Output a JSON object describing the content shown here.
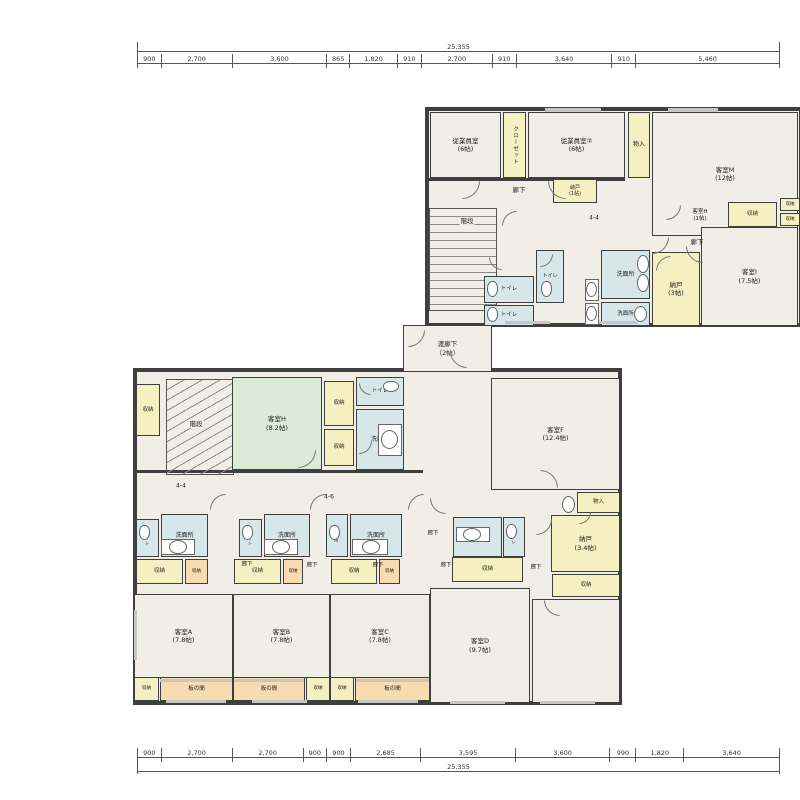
{
  "colors": {
    "cream": "#f0eee7",
    "yellow": "#f5f0c1",
    "blue": "#d7e6e9",
    "green": "#dcead7",
    "peach": "#f7dcb2",
    "wall": "#3f3f3f",
    "line": "#666666"
  },
  "dimensions": {
    "top": {
      "total": "25,355",
      "segments": [
        {
          "label": "900",
          "mm": 900
        },
        {
          "label": "2,700",
          "mm": 2700
        },
        {
          "label": "3,600",
          "mm": 3600
        },
        {
          "label": "865",
          "mm": 865
        },
        {
          "label": "1,820",
          "mm": 1820
        },
        {
          "label": "910",
          "mm": 910
        },
        {
          "label": "2,700",
          "mm": 2700
        },
        {
          "label": "910",
          "mm": 910
        },
        {
          "label": "3,640",
          "mm": 3640
        },
        {
          "label": "910",
          "mm": 910
        },
        {
          "label": "5,460",
          "mm": 5460
        }
      ]
    },
    "bottom": {
      "total": "25,355",
      "segments": [
        {
          "label": "900",
          "mm": 900
        },
        {
          "label": "2,700",
          "mm": 2700
        },
        {
          "label": "2,700",
          "mm": 2700
        },
        {
          "label": "900",
          "mm": 900
        },
        {
          "label": "900",
          "mm": 900
        },
        {
          "label": "2,685",
          "mm": 2685
        },
        {
          "label": "3,595",
          "mm": 3595
        },
        {
          "label": "3,600",
          "mm": 3600
        },
        {
          "label": "990",
          "mm": 990
        },
        {
          "label": "1,820",
          "mm": 1820
        },
        {
          "label": "3,640",
          "mm": 3640
        }
      ]
    }
  },
  "sections": [
    {
      "id": "upper-wing",
      "x": 425,
      "y": 107,
      "w": 378,
      "h": 220
    },
    {
      "id": "lower-wing",
      "x": 133,
      "y": 368,
      "w": 489,
      "h": 337
    }
  ],
  "rooms": [
    {
      "id": "staff-room-1",
      "label": "従業員室\n(6帖)",
      "x": 430,
      "y": 112,
      "w": 71,
      "h": 66,
      "fill": "cream"
    },
    {
      "id": "closet-strip",
      "label": "クローゼット",
      "x": 503,
      "y": 112,
      "w": 23,
      "h": 66,
      "fill": "yellow",
      "vert": true,
      "fs": 5.5
    },
    {
      "id": "staff-room-2",
      "label": "従業員室②\n(6帖)",
      "x": 528,
      "y": 112,
      "w": 97,
      "h": 66,
      "fill": "cream"
    },
    {
      "id": "monoire-upper",
      "label": "物入",
      "x": 628,
      "y": 112,
      "w": 22,
      "h": 66,
      "fill": "yellow",
      "fs": 6
    },
    {
      "id": "guest-room-M",
      "label": "客室M\n(12帖)",
      "x": 652,
      "y": 112,
      "w": 146,
      "h": 124,
      "fill": "cream"
    },
    {
      "id": "nando-1",
      "label": "納戸\n(1帖)",
      "x": 553,
      "y": 179,
      "w": 44,
      "h": 24,
      "fill": "yellow",
      "fs": 5
    },
    {
      "id": "shuno-upper",
      "label": "収納",
      "x": 728,
      "y": 202,
      "w": 49,
      "h": 25,
      "fill": "yellow",
      "fs": 5.5
    },
    {
      "id": "shuno-edge-1",
      "label": "収納",
      "x": 780,
      "y": 198,
      "w": 20,
      "h": 13,
      "fill": "yellow",
      "fs": 4.5,
      "clip": true
    },
    {
      "id": "shuno-edge-2",
      "label": "収納",
      "x": 780,
      "y": 213,
      "w": 20,
      "h": 13,
      "fill": "yellow",
      "fs": 4.5,
      "clip": true
    },
    {
      "id": "toilet-up-1",
      "label": "トイレ",
      "x": 484,
      "y": 276,
      "w": 50,
      "h": 27,
      "fill": "blue",
      "fs": 5.5
    },
    {
      "id": "toilet-up-2",
      "label": "トイレ",
      "x": 536,
      "y": 250,
      "w": 28,
      "h": 53,
      "fill": "blue",
      "fs": 5
    },
    {
      "id": "toilet-up-3",
      "label": "トイレ",
      "x": 484,
      "y": 305,
      "w": 50,
      "h": 21,
      "fill": "blue",
      "fs": 5.5
    },
    {
      "id": "washroom-up-1",
      "label": "洗面所",
      "x": 601,
      "y": 250,
      "w": 49,
      "h": 49,
      "fill": "blue",
      "fs": 6
    },
    {
      "id": "washroom-up-2",
      "label": "洗面所",
      "x": 601,
      "y": 302,
      "w": 49,
      "h": 24,
      "fill": "blue",
      "fs": 5.5
    },
    {
      "id": "nando-3",
      "label": "納戸\n(3帖)",
      "x": 652,
      "y": 252,
      "w": 48,
      "h": 74,
      "fill": "yellow"
    },
    {
      "id": "guest-room-I",
      "label": "客室I\n(7.5帖)",
      "x": 701,
      "y": 227,
      "w": 97,
      "h": 99,
      "fill": "cream"
    },
    {
      "id": "watari-rouka",
      "label": "渡廊下\n（2帖）",
      "x": 403,
      "y": 325,
      "w": 89,
      "h": 47,
      "fill": "cream"
    },
    {
      "id": "shuno-left",
      "label": "収納",
      "x": 136,
      "y": 384,
      "w": 24,
      "h": 52,
      "fill": "yellow",
      "fs": 5.5
    },
    {
      "id": "guest-room-H",
      "label": "客室H\n(8.2帖)",
      "x": 232,
      "y": 377,
      "w": 90,
      "h": 93,
      "fill": "green"
    },
    {
      "id": "shuno-h-1",
      "label": "収納",
      "x": 324,
      "y": 381,
      "w": 30,
      "h": 45,
      "fill": "yellow",
      "fs": 5.5
    },
    {
      "id": "shuno-h-2",
      "label": "収納",
      "x": 324,
      "y": 429,
      "w": 30,
      "h": 37,
      "fill": "yellow",
      "fs": 5.5
    },
    {
      "id": "toilet-h",
      "label": "トイレ",
      "x": 356,
      "y": 377,
      "w": 48,
      "h": 29,
      "fill": "blue",
      "fs": 5.5
    },
    {
      "id": "washroom-h",
      "label": "洗面所",
      "x": 356,
      "y": 409,
      "w": 48,
      "h": 61,
      "fill": "blue",
      "fs": 6
    },
    {
      "id": "guest-room-F",
      "label": "客室F\n(12.4帖)",
      "x": 491,
      "y": 378,
      "w": 129,
      "h": 112,
      "fill": "cream"
    },
    {
      "id": "monoire-lower",
      "label": "物入",
      "x": 577,
      "y": 492,
      "w": 43,
      "h": 21,
      "fill": "yellow",
      "fs": 5.5
    },
    {
      "id": "nando-34",
      "label": "納戸\n(3.4帖)",
      "x": 551,
      "y": 515,
      "w": 69,
      "h": 57,
      "fill": "yellow"
    },
    {
      "id": "shuno-nando",
      "label": "収納",
      "x": 552,
      "y": 574,
      "w": 68,
      "h": 23,
      "fill": "yellow",
      "fs": 5.5
    },
    {
      "id": "toilet-a",
      "label": "トイレ",
      "x": 136,
      "y": 519,
      "w": 23,
      "h": 38,
      "fill": "blue",
      "fs": 4,
      "vert": true
    },
    {
      "id": "washroom-a",
      "label": "洗面所",
      "x": 161,
      "y": 514,
      "w": 47,
      "h": 43,
      "fill": "blue",
      "fs": 6
    },
    {
      "id": "shuno-a1",
      "label": "収納",
      "x": 136,
      "y": 559,
      "w": 47,
      "h": 25,
      "fill": "yellow",
      "fs": 5.5
    },
    {
      "id": "shuno-a2",
      "label": "収納",
      "x": 185,
      "y": 559,
      "w": 23,
      "h": 25,
      "fill": "peach",
      "fs": 4.5
    },
    {
      "id": "guest-room-A",
      "label": "客室A\n(7.8帖)",
      "x": 134,
      "y": 594,
      "w": 99,
      "h": 84,
      "fill": "cream"
    },
    {
      "id": "shuno-a3",
      "label": "収納",
      "x": 134,
      "y": 677,
      "w": 25,
      "h": 24,
      "fill": "yellow",
      "fs": 4.5
    },
    {
      "id": "itanoma-a",
      "label": "板の間",
      "x": 160,
      "y": 677,
      "w": 73,
      "h": 24,
      "fill": "peach",
      "fs": 5.5
    },
    {
      "id": "toilet-b",
      "label": "トイレ",
      "x": 239,
      "y": 519,
      "w": 23,
      "h": 38,
      "fill": "blue",
      "fs": 4,
      "vert": true
    },
    {
      "id": "washroom-b",
      "label": "洗面所",
      "x": 264,
      "y": 514,
      "w": 46,
      "h": 43,
      "fill": "blue",
      "fs": 6
    },
    {
      "id": "shuno-b1",
      "label": "収納",
      "x": 234,
      "y": 559,
      "w": 47,
      "h": 25,
      "fill": "yellow",
      "fs": 5.5
    },
    {
      "id": "shuno-b2",
      "label": "収納",
      "x": 283,
      "y": 559,
      "w": 20,
      "h": 25,
      "fill": "peach",
      "fs": 4.5
    },
    {
      "id": "guest-room-B",
      "label": "客室B\n(7.8帖)",
      "x": 233,
      "y": 594,
      "w": 97,
      "h": 84,
      "fill": "cream"
    },
    {
      "id": "itanoma-b",
      "label": "板の間",
      "x": 233,
      "y": 677,
      "w": 72,
      "h": 24,
      "fill": "peach",
      "fs": 5.5
    },
    {
      "id": "shuno-b3",
      "label": "収納",
      "x": 306,
      "y": 677,
      "w": 24,
      "h": 24,
      "fill": "yellow",
      "fs": 4.5
    },
    {
      "id": "washroom-c-small",
      "label": "洗面所",
      "x": 326,
      "y": 514,
      "w": 22,
      "h": 43,
      "fill": "blue",
      "fs": 4,
      "vert": true
    },
    {
      "id": "washroom-c",
      "label": "洗面所",
      "x": 350,
      "y": 514,
      "w": 52,
      "h": 43,
      "fill": "blue",
      "fs": 6
    },
    {
      "id": "shuno-c1",
      "label": "収納",
      "x": 331,
      "y": 559,
      "w": 46,
      "h": 25,
      "fill": "yellow",
      "fs": 5.5
    },
    {
      "id": "shuno-c2",
      "label": "収納",
      "x": 379,
      "y": 559,
      "w": 21,
      "h": 25,
      "fill": "peach",
      "fs": 4.5
    },
    {
      "id": "guest-room-C",
      "label": "客室C\n(7.8帖)",
      "x": 330,
      "y": 594,
      "w": 100,
      "h": 84,
      "fill": "cream"
    },
    {
      "id": "shuno-c3",
      "label": "収納",
      "x": 330,
      "y": 677,
      "w": 24,
      "h": 24,
      "fill": "yellow",
      "fs": 4.5
    },
    {
      "id": "itanoma-c",
      "label": "板の間",
      "x": 355,
      "y": 677,
      "w": 75,
      "h": 24,
      "fill": "peach",
      "fs": 5.5
    },
    {
      "id": "washroom-d",
      "label": "洗面所",
      "x": 453,
      "y": 517,
      "w": 49,
      "h": 40,
      "fill": "blue",
      "fs": 6
    },
    {
      "id": "toilet-d",
      "label": "トイレ",
      "x": 503,
      "y": 517,
      "w": 22,
      "h": 40,
      "fill": "blue",
      "fs": 4,
      "vert": true
    },
    {
      "id": "shuno-d1",
      "label": "収納",
      "x": 452,
      "y": 557,
      "w": 71,
      "h": 25,
      "fill": "yellow",
      "fs": 5.5
    },
    {
      "id": "guest-room-D",
      "label": "客室D\n(9.7帖)",
      "x": 430,
      "y": 588,
      "w": 100,
      "h": 115,
      "fill": "cream"
    },
    {
      "id": "guest-room-unlabeled",
      "label": "",
      "x": 532,
      "y": 599,
      "w": 88,
      "h": 104,
      "fill": "cream"
    }
  ],
  "annotations": [
    {
      "text": "階段",
      "x": 467,
      "y": 221,
      "chip": true
    },
    {
      "text": "階段",
      "x": 196,
      "y": 424,
      "chip": true
    },
    {
      "text": "廊下",
      "x": 519,
      "y": 190
    },
    {
      "text": "廊下",
      "x": 697,
      "y": 242
    },
    {
      "text": "客室H\n(1帖)",
      "x": 700,
      "y": 216,
      "fs": 5.5
    },
    {
      "text": "4-4",
      "x": 594,
      "y": 218,
      "fs": 6
    },
    {
      "text": "4-4",
      "x": 181,
      "y": 486,
      "fs": 6
    },
    {
      "text": "4-6",
      "x": 329,
      "y": 497,
      "fs": 6
    },
    {
      "text": "廊下",
      "x": 433,
      "y": 534,
      "fs": 5.5
    },
    {
      "text": "廊下",
      "x": 247,
      "y": 565,
      "fs": 5.5
    },
    {
      "text": "廊下",
      "x": 312,
      "y": 566,
      "fs": 5.5
    },
    {
      "text": "廊下",
      "x": 378,
      "y": 566,
      "fs": 5.5
    },
    {
      "text": "廊下",
      "x": 446,
      "y": 566,
      "fs": 5.5
    },
    {
      "text": "廊下",
      "x": 536,
      "y": 568,
      "fs": 5.5
    }
  ],
  "stairs": [
    {
      "id": "stairs-upper",
      "x": 429,
      "y": 208,
      "w": 68,
      "h": 103,
      "kind": "straight"
    },
    {
      "id": "stairs-lower",
      "x": 166,
      "y": 379,
      "w": 68,
      "h": 96,
      "kind": "fan"
    }
  ],
  "walls": [
    {
      "x": 403,
      "y": 325,
      "w": 4,
      "h": 47
    },
    {
      "x": 488,
      "y": 325,
      "w": 4,
      "h": 47
    },
    {
      "x": 425,
      "y": 178,
      "w": 200,
      "h": 3
    },
    {
      "x": 133,
      "y": 470,
      "w": 290,
      "h": 3
    }
  ],
  "windows": [
    {
      "x": 545,
      "y": 108,
      "w": 56,
      "h": 4
    },
    {
      "x": 668,
      "y": 108,
      "w": 50,
      "h": 4
    },
    {
      "x": 505,
      "y": 321,
      "w": 45,
      "h": 3
    },
    {
      "x": 598,
      "y": 321,
      "w": 40,
      "h": 3
    },
    {
      "x": 160,
      "y": 679,
      "w": 72,
      "h": 3
    },
    {
      "x": 234,
      "y": 679,
      "w": 70,
      "h": 3
    },
    {
      "x": 356,
      "y": 679,
      "w": 73,
      "h": 3
    },
    {
      "x": 166,
      "y": 700,
      "w": 60,
      "h": 3
    },
    {
      "x": 252,
      "y": 700,
      "w": 55,
      "h": 3
    },
    {
      "x": 358,
      "y": 700,
      "w": 60,
      "h": 3
    },
    {
      "x": 450,
      "y": 701,
      "w": 55,
      "h": 3
    },
    {
      "x": 540,
      "y": 701,
      "w": 55,
      "h": 3
    },
    {
      "x": 134,
      "y": 610,
      "w": 3,
      "h": 50
    }
  ],
  "doors": [
    {
      "x": 462,
      "y": 181,
      "r": 18,
      "rot": 0
    },
    {
      "x": 548,
      "y": 181,
      "r": 18,
      "rot": 90
    },
    {
      "x": 652,
      "y": 237,
      "r": 17,
      "rot": 0
    },
    {
      "x": 686,
      "y": 246,
      "r": 17,
      "rot": 90
    },
    {
      "x": 656,
      "y": 256,
      "r": 15,
      "rot": 180
    },
    {
      "x": 540,
      "y": 254,
      "r": 13,
      "rot": 0
    },
    {
      "x": 489,
      "y": 257,
      "r": 13,
      "rot": 90
    },
    {
      "x": 502,
      "y": 211,
      "r": 15,
      "rot": 180
    },
    {
      "x": 666,
      "y": 205,
      "r": 15,
      "rot": 0
    },
    {
      "x": 408,
      "y": 330,
      "r": 17,
      "rot": 0
    },
    {
      "x": 450,
      "y": 351,
      "r": 17,
      "rot": 90
    },
    {
      "x": 298,
      "y": 450,
      "r": 18,
      "rot": 0
    },
    {
      "x": 359,
      "y": 383,
      "r": 12,
      "rot": 90
    },
    {
      "x": 359,
      "y": 441,
      "r": 13,
      "rot": 0
    },
    {
      "x": 210,
      "y": 494,
      "r": 16,
      "rot": 180
    },
    {
      "x": 310,
      "y": 494,
      "r": 16,
      "rot": 180
    },
    {
      "x": 408,
      "y": 494,
      "r": 16,
      "rot": 180
    },
    {
      "x": 430,
      "y": 498,
      "r": 16,
      "rot": 90
    },
    {
      "x": 536,
      "y": 519,
      "r": 16,
      "rot": 0
    },
    {
      "x": 540,
      "y": 470,
      "r": 18,
      "rot": 270
    },
    {
      "x": 544,
      "y": 600,
      "r": 16,
      "rot": 90
    },
    {
      "x": 579,
      "y": 512,
      "r": 12,
      "rot": 0
    }
  ],
  "fixtures": [
    {
      "t": "wc",
      "x": 487,
      "y": 281,
      "w": 11,
      "h": 16
    },
    {
      "t": "wc",
      "x": 541,
      "y": 281,
      "w": 11,
      "h": 16
    },
    {
      "t": "wc",
      "x": 487,
      "y": 307,
      "w": 11,
      "h": 15
    },
    {
      "t": "counter",
      "x": 585,
      "y": 279,
      "w": 14,
      "h": 22
    },
    {
      "t": "sink",
      "x": 586,
      "y": 282,
      "w": 11,
      "h": 15
    },
    {
      "t": "counter",
      "x": 585,
      "y": 303,
      "w": 14,
      "h": 22
    },
    {
      "t": "sink",
      "x": 586,
      "y": 306,
      "w": 11,
      "h": 15
    },
    {
      "t": "sink",
      "x": 637,
      "y": 255,
      "w": 12,
      "h": 18
    },
    {
      "t": "sink",
      "x": 637,
      "y": 274,
      "w": 12,
      "h": 18
    },
    {
      "t": "sink",
      "x": 634,
      "y": 306,
      "w": 13,
      "h": 16
    },
    {
      "t": "wc",
      "x": 383,
      "y": 381,
      "w": 16,
      "h": 11
    },
    {
      "t": "counter",
      "x": 378,
      "y": 424,
      "w": 24,
      "h": 32
    },
    {
      "t": "sink",
      "x": 381,
      "y": 430,
      "w": 17,
      "h": 19
    },
    {
      "t": "wc",
      "x": 139,
      "y": 525,
      "w": 11,
      "h": 15
    },
    {
      "t": "counter",
      "x": 161,
      "y": 539,
      "w": 34,
      "h": 16
    },
    {
      "t": "sink",
      "x": 169,
      "y": 540,
      "w": 18,
      "h": 14
    },
    {
      "t": "wc",
      "x": 242,
      "y": 525,
      "w": 11,
      "h": 15
    },
    {
      "t": "counter",
      "x": 264,
      "y": 539,
      "w": 34,
      "h": 16
    },
    {
      "t": "sink",
      "x": 272,
      "y": 540,
      "w": 18,
      "h": 14
    },
    {
      "t": "wc",
      "x": 329,
      "y": 525,
      "w": 11,
      "h": 15
    },
    {
      "t": "counter",
      "x": 352,
      "y": 539,
      "w": 36,
      "h": 16
    },
    {
      "t": "sink",
      "x": 362,
      "y": 540,
      "w": 18,
      "h": 14
    },
    {
      "t": "counter",
      "x": 456,
      "y": 527,
      "w": 34,
      "h": 15
    },
    {
      "t": "sink",
      "x": 463,
      "y": 528,
      "w": 18,
      "h": 13
    },
    {
      "t": "wc",
      "x": 506,
      "y": 524,
      "w": 11,
      "h": 15
    },
    {
      "t": "sink",
      "x": 562,
      "y": 496,
      "w": 13,
      "h": 17
    }
  ],
  "layout_px": {
    "dim_top": {
      "x": 137,
      "y_total": 42,
      "y_segs": 56,
      "w": 643
    },
    "dim_bottom": {
      "x": 137,
      "y_segs": 748,
      "y_total": 766,
      "w": 643
    }
  }
}
